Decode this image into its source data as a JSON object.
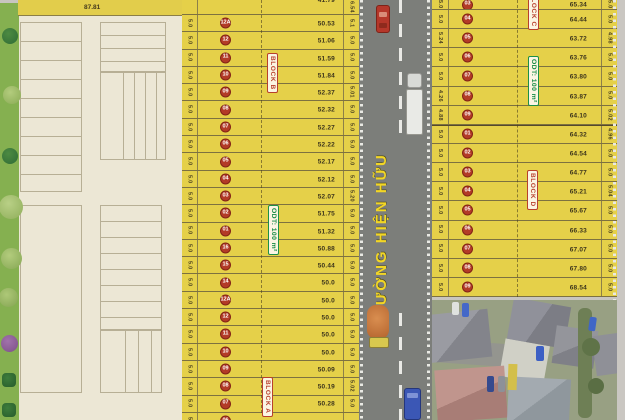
{
  "top_edge": {
    "length": "87.81"
  },
  "road": {
    "name": "ĐƯỜNG HIỆN HỮU"
  },
  "labels": {
    "block_a": "BLOCK A",
    "block_b": "BLOCK B",
    "block_c": "BLOCK C",
    "block_d": "BLOCK D",
    "odt_left": "ODT: 100 m²",
    "odt_right": "ODT: 100 m²"
  },
  "left_column": {
    "rows": [
      {
        "lot": "",
        "len": "41.79",
        "wl": "",
        "wr": "6.54"
      },
      {
        "lot": "12A",
        "len": "50.53",
        "wl": "5.0",
        "wr": "5.1"
      },
      {
        "lot": "12",
        "len": "51.06",
        "wl": "5.0",
        "wr": "5.0"
      },
      {
        "lot": "11",
        "len": "51.59",
        "wl": "5.0",
        "wr": "5.0"
      },
      {
        "lot": "10",
        "len": "51.84",
        "wl": "5.0",
        "wr": "5.0"
      },
      {
        "lot": "09",
        "len": "52.37",
        "wl": "5.0",
        "wr": "5.01"
      },
      {
        "lot": "08",
        "len": "52.32",
        "wl": "5.0",
        "wr": "5.0"
      },
      {
        "lot": "07",
        "len": "52.27",
        "wl": "5.0",
        "wr": "5.0"
      },
      {
        "lot": "06",
        "len": "52.22",
        "wl": "5.0",
        "wr": "5.0"
      },
      {
        "lot": "05",
        "len": "52.17",
        "wl": "5.0",
        "wr": "5.0"
      },
      {
        "lot": "04",
        "len": "52.12",
        "wl": "5.0",
        "wr": "5.0"
      },
      {
        "lot": "03",
        "len": "52.07",
        "wl": "5.0",
        "wr": "5.20"
      },
      {
        "lot": "02",
        "len": "51.75",
        "wl": "5.0",
        "wr": "5.0"
      },
      {
        "lot": "01",
        "len": "51.32",
        "wl": "5.0",
        "wr": "5.0"
      },
      {
        "lot": "16",
        "len": "50.88",
        "wl": "5.0",
        "wr": "5.0"
      },
      {
        "lot": "15",
        "len": "50.44",
        "wl": "5.0",
        "wr": "5.0"
      },
      {
        "lot": "14",
        "len": "50.0",
        "wl": "5.0",
        "wr": "5.0"
      },
      {
        "lot": "12A",
        "len": "50.0",
        "wl": "5.0",
        "wr": "5.0"
      },
      {
        "lot": "12",
        "len": "50.0",
        "wl": "5.0",
        "wr": "5.0"
      },
      {
        "lot": "11",
        "len": "50.0",
        "wl": "5.0",
        "wr": "5.0"
      },
      {
        "lot": "10",
        "len": "50.0",
        "wl": "5.0",
        "wr": "5.0"
      },
      {
        "lot": "09",
        "len": "50.09",
        "wl": "5.0",
        "wr": "5.0"
      },
      {
        "lot": "08",
        "len": "50.19",
        "wl": "5.0",
        "wr": "5.02"
      },
      {
        "lot": "07",
        "len": "50.28",
        "wl": "5.0",
        "wr": "5.0"
      },
      {
        "lot": "06",
        "len": "",
        "wl": "5.0",
        "wr": ""
      }
    ]
  },
  "right_column": {
    "rows": [
      {
        "lot": "03",
        "len": "65.34",
        "wl": "5.0",
        "wr": "5.0"
      },
      {
        "lot": "04",
        "len": "64.44",
        "wl": "5.0",
        "wr": "5.0"
      },
      {
        "lot": "05",
        "len": "63.72",
        "wl": "5.24",
        "wr": "4.98"
      },
      {
        "lot": "06",
        "len": "63.76",
        "wl": "5.0",
        "wr": "5.0"
      },
      {
        "lot": "07",
        "len": "63.80",
        "wl": "5.0",
        "wr": "5.0"
      },
      {
        "lot": "08",
        "len": "63.87",
        "wl": "4.26",
        "wr": "5.0"
      },
      {
        "lot": "09",
        "len": "64.10",
        "wl": "4.88",
        "wr": "5.02"
      },
      {
        "lot": "01",
        "len": "64.32",
        "wl": "5.0",
        "wr": "4.96",
        "thick": true
      },
      {
        "lot": "02",
        "len": "64.54",
        "wl": "5.0",
        "wr": "5.0"
      },
      {
        "lot": "03",
        "len": "64.77",
        "wl": "5.0",
        "wr": "5.0"
      },
      {
        "lot": "04",
        "len": "65.21",
        "wl": "5.0",
        "wr": "5.04"
      },
      {
        "lot": "05",
        "len": "65.67",
        "wl": "5.0",
        "wr": "5.0"
      },
      {
        "lot": "06",
        "len": "66.33",
        "wl": "5.0",
        "wr": "5.0"
      },
      {
        "lot": "07",
        "len": "67.07",
        "wl": "5.0",
        "wr": "5.0"
      },
      {
        "lot": "08",
        "len": "67.80",
        "wl": "5.0",
        "wr": "5.0"
      },
      {
        "lot": "09",
        "len": "68.54",
        "wl": "5.0",
        "wr": "5.0"
      }
    ]
  }
}
